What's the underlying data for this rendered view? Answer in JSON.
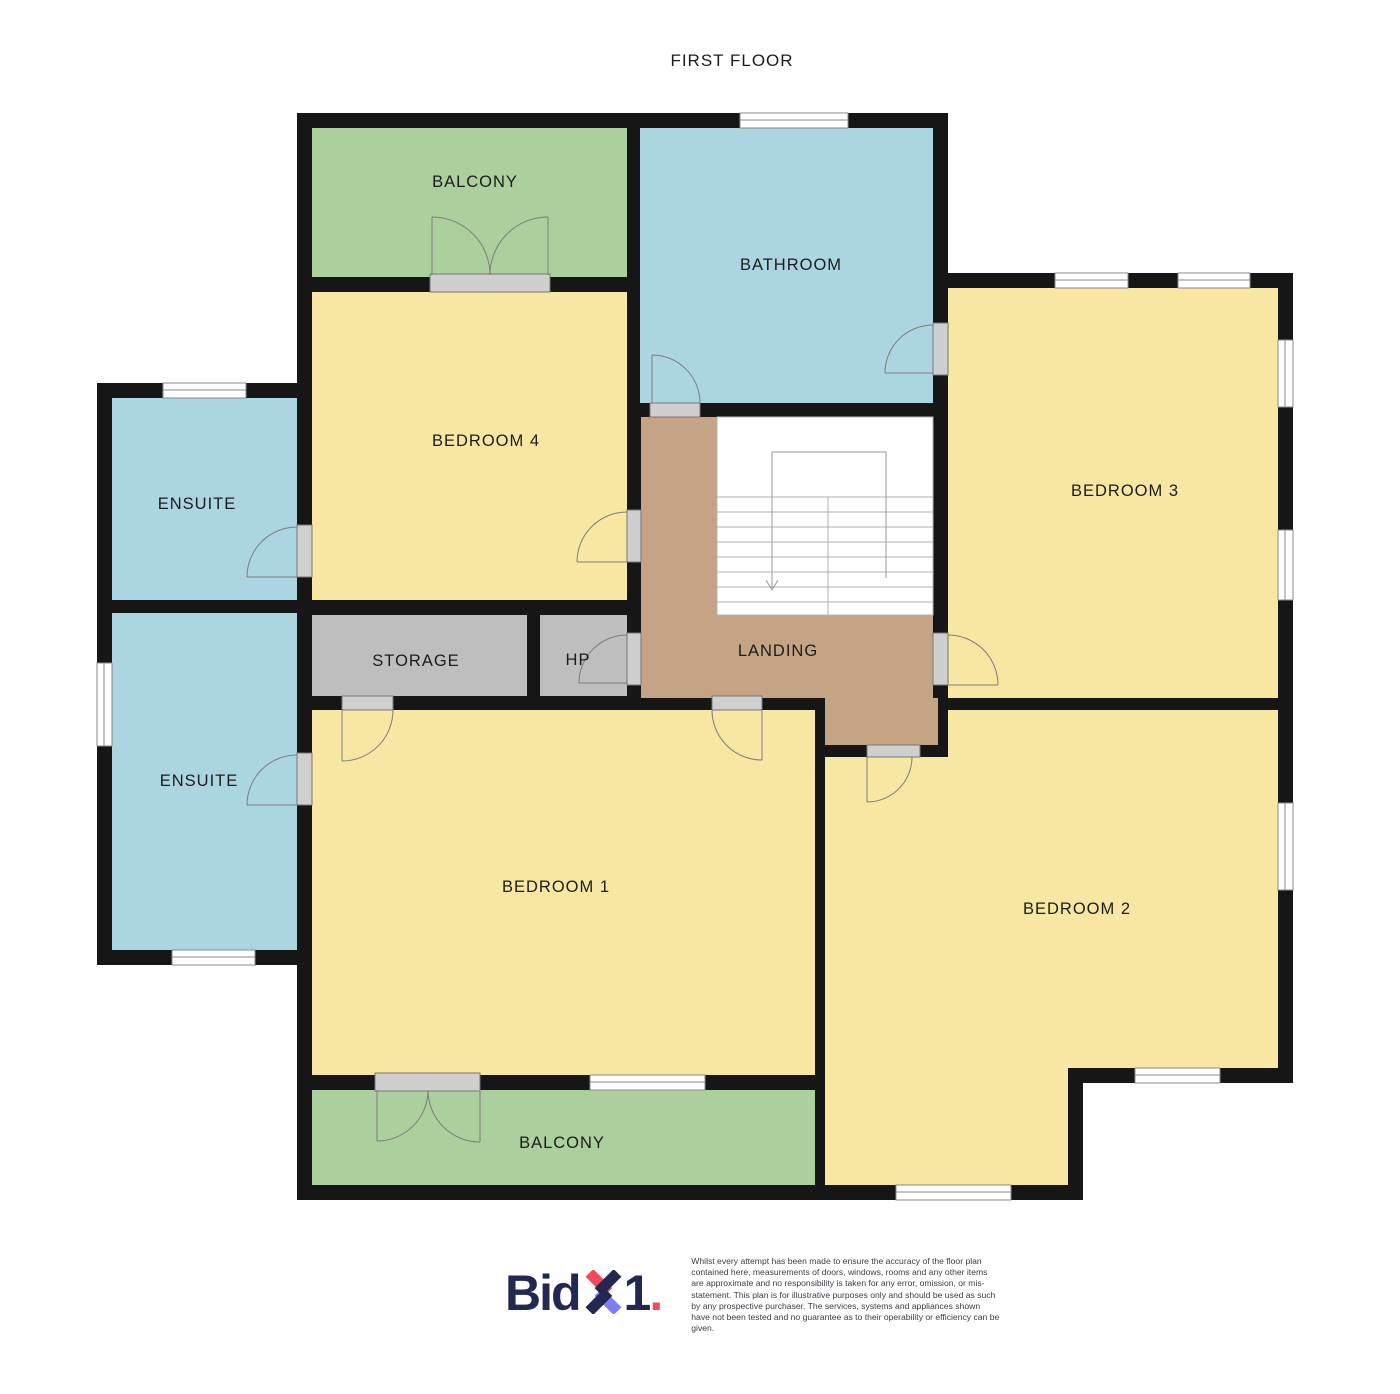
{
  "title": "FIRST FLOOR",
  "palette": {
    "wall": "#161616",
    "room_yellow": "#f8e6a3",
    "room_blue": "#abd5e0",
    "room_green": "#abcf9d",
    "landing_tan": "#c5a385",
    "storage_grey": "#bebebe",
    "threshold_grey": "#cfcfcf",
    "logo_navy": "#232850",
    "logo_red": "#f4495d",
    "logo_blue": "#7b7ff2"
  },
  "rooms": {
    "balcony_top": {
      "label": "BALCONY"
    },
    "bathroom": {
      "label": "BATHROOM"
    },
    "bedroom4": {
      "label": "BEDROOM 4"
    },
    "bedroom3": {
      "label": "BEDROOM 3"
    },
    "ensuite_top": {
      "label": "ENSUITE"
    },
    "ensuite_bottom": {
      "label": "ENSUITE"
    },
    "storage": {
      "label": "STORAGE"
    },
    "hp": {
      "label": "HP"
    },
    "landing": {
      "label": "LANDING"
    },
    "bedroom1": {
      "label": "BEDROOM 1"
    },
    "bedroom2": {
      "label": "BEDROOM 2"
    },
    "balcony_bottom": {
      "label": "BALCONY"
    }
  },
  "footer": {
    "logo_bid": "Bid",
    "logo_one": "1",
    "logo_dot": ".",
    "disclaimer": "Whilst every attempt has been made to ensure the accuracy of the floor plan contained here, measurements of doors, windows, rooms and any other items are approximate and no responsibility is taken for any error, omission, or mis-statement. This plan is for illustrative purposes only and should be used as such by any prospective purchaser. The services, systems and appliances shown have not been tested and no guarantee as to their operability or efficiency can be given."
  }
}
